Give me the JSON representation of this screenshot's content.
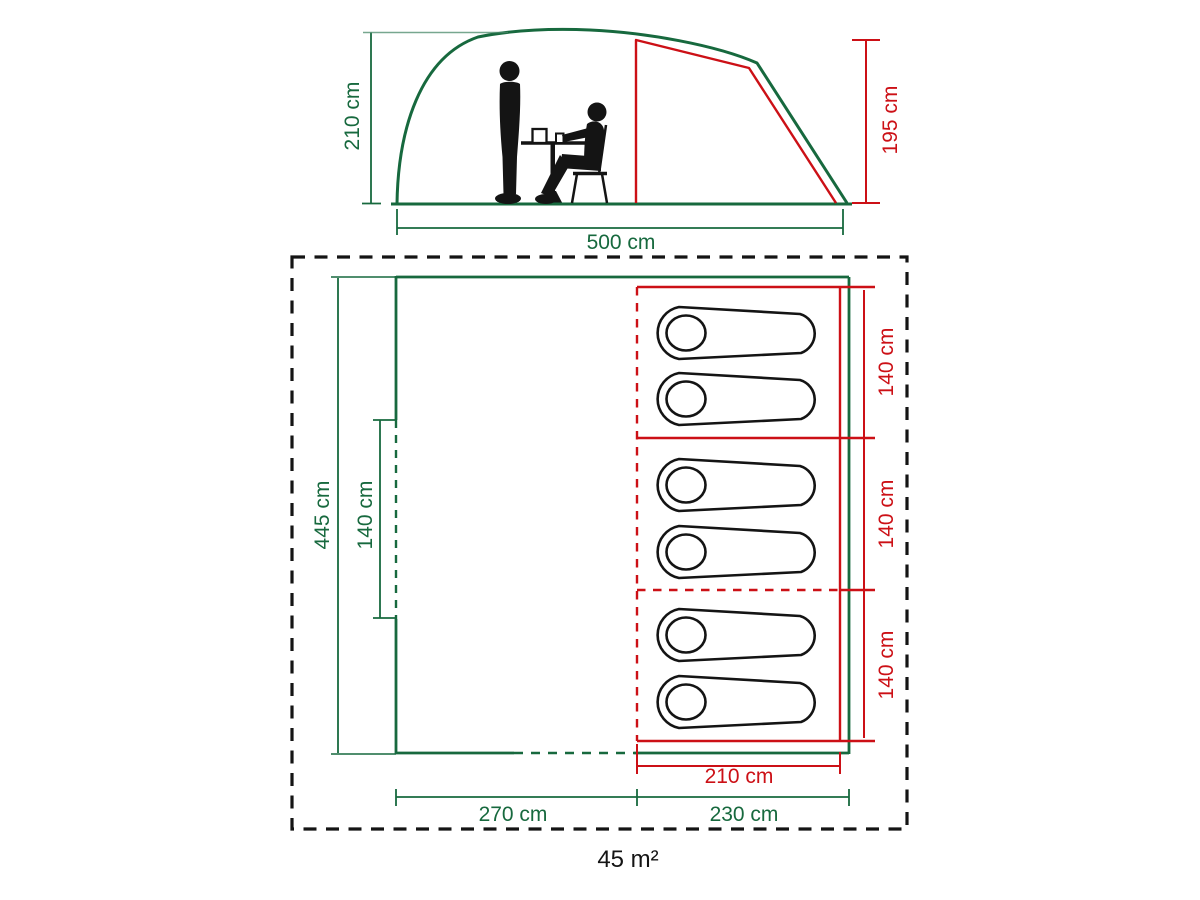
{
  "diagram": {
    "type": "tent-dimensions-diagram",
    "colors": {
      "tent_green": "#17693e",
      "inner_red": "#cc1016",
      "outline_black": "#141414"
    },
    "elevation": {
      "outer_height_label": "210 cm",
      "inner_height_label": "195 cm",
      "length_label": "500 cm"
    },
    "floorplan": {
      "depth_label": "445 cm",
      "door_width_label": "140 cm",
      "bedroom_width_labels": [
        "140 cm",
        "140 cm",
        "140 cm"
      ],
      "bedroom_inner_length_label": "210 cm",
      "living_area_length_label": "270 cm",
      "bedroom_area_length_label": "230 cm",
      "sleeping_bag_count": 6,
      "area_label": "45 m²"
    }
  }
}
